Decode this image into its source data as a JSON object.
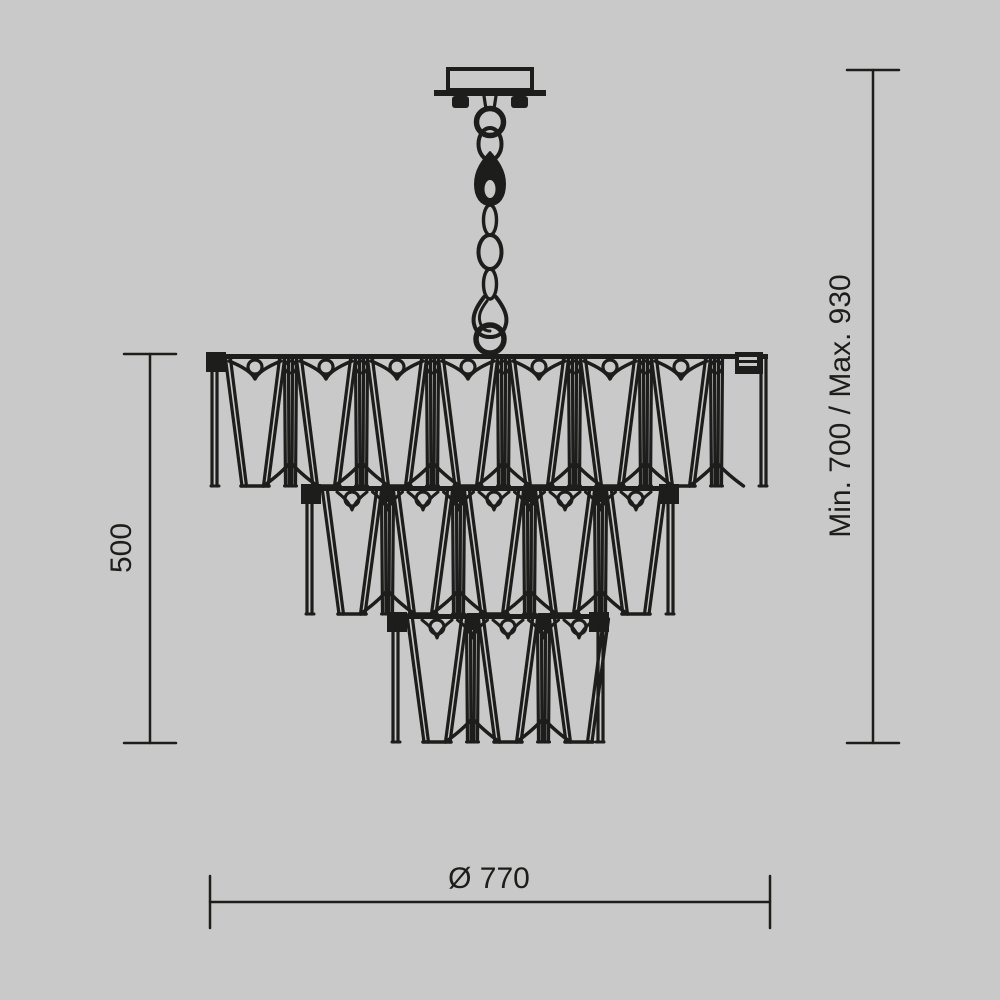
{
  "page": {
    "colors": {
      "background": "#c9c9c9",
      "line": "#1d1d1b"
    }
  },
  "dimensions": {
    "body_height": "500",
    "suspension_height": "Min. 700 / Max. 930",
    "diameter": "Ø 770"
  },
  "drawing": {
    "canopy": {
      "box": [
        448,
        69,
        84,
        21
      ],
      "plate": [
        434,
        90,
        112,
        6
      ],
      "nubs": [
        [
          452,
          96,
          17,
          12
        ],
        [
          511,
          96,
          17,
          12
        ]
      ],
      "collar": [
        484,
        96,
        496,
        109
      ]
    },
    "chain": {
      "ring_top": [
        490,
        122,
        13.5
      ],
      "ring_bottom": [
        490,
        339,
        14
      ],
      "links": [
        [
          490,
          144,
          11.5,
          16,
          4
        ],
        [
          490,
          220,
          6.5,
          15,
          3.4
        ],
        [
          490,
          252,
          11.5,
          17,
          4
        ],
        [
          490,
          284,
          6.5,
          15,
          3.4
        ]
      ],
      "swivel_hole": [
        490,
        189,
        5.5,
        9
      ]
    },
    "tiers": [
      {
        "left": 210,
        "right": 768,
        "rail_y": 354,
        "bottom_y": 486,
        "wide_centers": [
          255,
          326,
          397,
          468,
          539,
          610,
          681
        ],
        "narrow_centers": [
          290.5,
          361.5,
          432.5,
          503.5,
          574.5,
          645.5,
          716.5
        ],
        "arch_centers": [
          290.5,
          361.5,
          432.5,
          503.5,
          574.5,
          645.5,
          716.5
        ],
        "clip_centers": [],
        "top_vees": true,
        "under_vees": false,
        "e_clip": true
      },
      {
        "left": 305,
        "right": 675,
        "rail_y": 486,
        "bottom_y": 614,
        "wide_centers": [
          352,
          423,
          494,
          565,
          636
        ],
        "narrow_centers": [
          387.5,
          458.5,
          529.5,
          600.5
        ],
        "arch_centers": [
          387.5,
          458.5,
          529.5,
          600.5
        ],
        "clip_centers": [
          387.5,
          458.5,
          529.5,
          600.5
        ],
        "top_vees": false,
        "under_vees": true,
        "e_clip": false
      },
      {
        "left": 391,
        "right": 605,
        "rail_y": 614,
        "bottom_y": 742,
        "wide_centers": [
          437,
          508,
          579
        ],
        "narrow_centers": [
          472.5,
          543.5
        ],
        "arch_centers": [
          472.5,
          543.5
        ],
        "clip_centers": [
          472.5,
          543.5
        ],
        "top_vees": false,
        "under_vees": true,
        "e_clip": false
      }
    ],
    "dim_lines": {
      "left": {
        "x": 150,
        "y1": 354,
        "y2": 743,
        "cap_half": 26,
        "label_x": 123,
        "label_y": 548
      },
      "right": {
        "x": 873,
        "y1": 70,
        "y2": 743,
        "cap_half": 26,
        "label_x": 842,
        "label_y": 406
      },
      "bottom": {
        "y": 902,
        "x1": 210,
        "x2": 770,
        "cap_half": 26,
        "label_x": 489,
        "label_y": 888
      }
    }
  }
}
